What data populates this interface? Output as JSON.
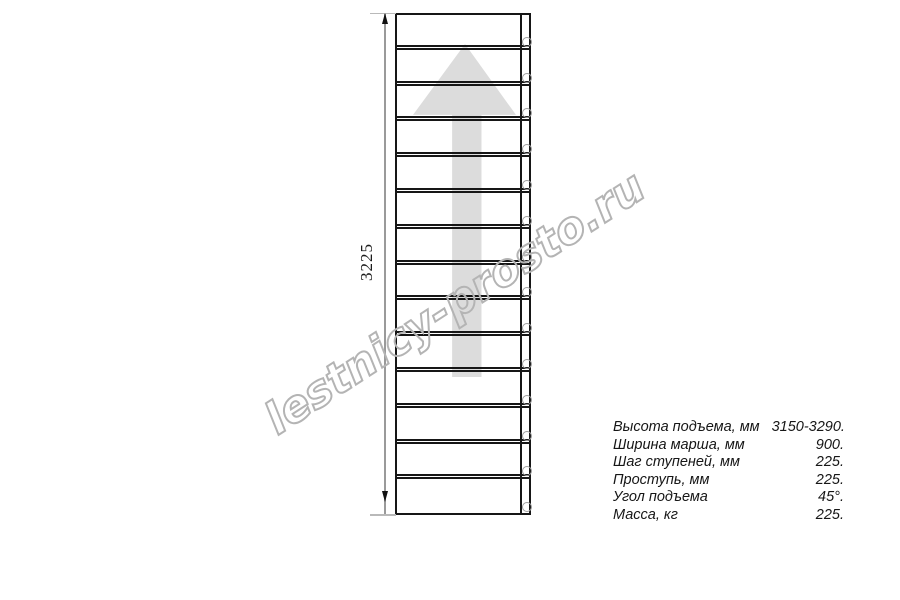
{
  "colors": {
    "line": "#161616",
    "arrow": "#dcdcdc",
    "dimension_line": "#9a9a9a",
    "circle": "#9e9e9e",
    "watermark": "#b4b4b4"
  },
  "drawing": {
    "dimension_label": "3225",
    "steps_count": 14,
    "step_boundaries_px": [
      50,
      86,
      121,
      157,
      193,
      229,
      265,
      300,
      336,
      372,
      408,
      444,
      479
    ],
    "circle_centers_y_px": [
      42,
      78,
      113,
      149,
      185,
      221,
      257,
      292,
      328,
      364,
      400,
      436,
      471,
      507
    ]
  },
  "watermark": {
    "text": "lestnicy-prosto.ru"
  },
  "specs": {
    "rows": [
      {
        "label": "Высота подъема, мм",
        "value": "3150-3290."
      },
      {
        "label": "Ширина марша, мм",
        "value": "900."
      },
      {
        "label": "Шаг ступеней, мм",
        "value": "225."
      },
      {
        "label": "Проступь, мм",
        "value": "225."
      },
      {
        "label": "Угол подъема",
        "value": "45°."
      },
      {
        "label": "Масса, кг",
        "value": "225."
      }
    ]
  }
}
